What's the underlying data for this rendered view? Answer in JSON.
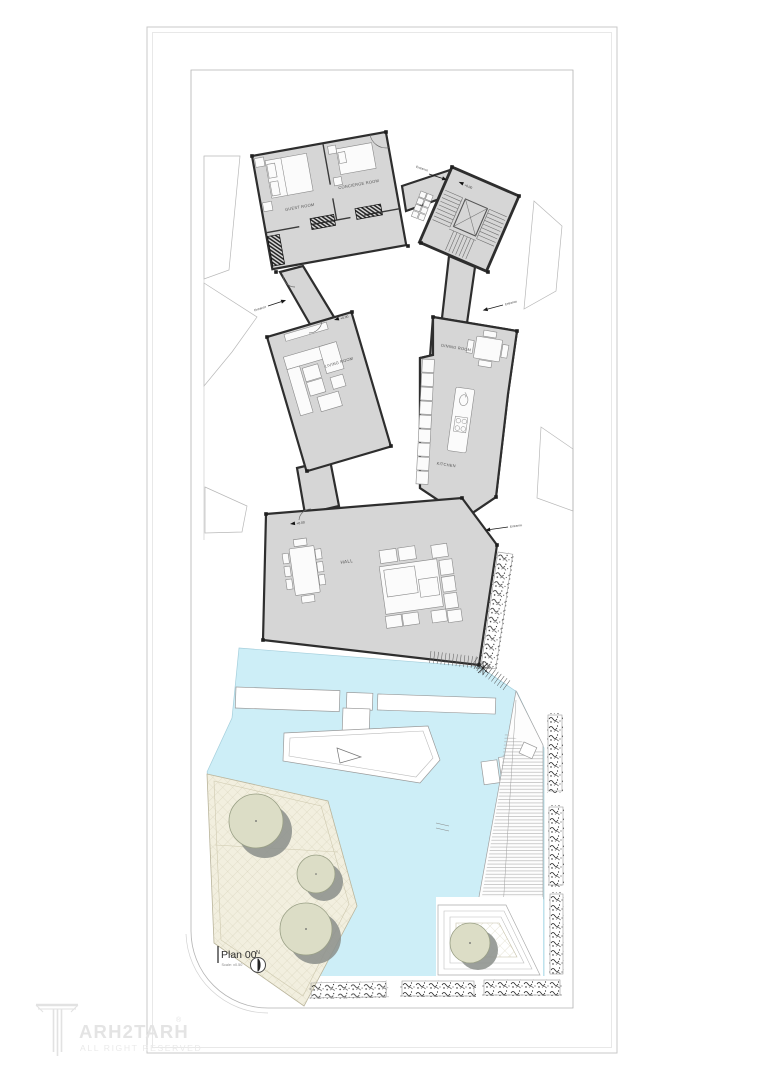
{
  "sheet": {
    "title_block": {
      "plan_name": "Plan 00",
      "scale_note": "Scale: x0.50",
      "north_label": "N"
    },
    "watermark": {
      "brand": "ARH2TARH",
      "registered_mark": "®",
      "tagline": "ALL RIGHT RESERVED"
    }
  },
  "rooms": [
    {
      "id": "guest-room",
      "label": "GUEST ROOM"
    },
    {
      "id": "concierge-room",
      "label": "CONCIERGE ROOM"
    },
    {
      "id": "living-room",
      "label": "LIVING ROOM"
    },
    {
      "id": "dining-room",
      "label": "DINING ROOM"
    },
    {
      "id": "kitchen",
      "label": "KITCHEN"
    },
    {
      "id": "hall",
      "label": "HALL"
    }
  ],
  "annotations": {
    "entrance_label": "Entrance",
    "level_marker_label": "+0.00"
  },
  "colors": {
    "building-fill": "#d6d6d6",
    "wall-stroke": "#2e2e2e",
    "pool-fill": "#cdeef7",
    "patio-fill": "#f2efdf",
    "patio-line": "#d6d1b8",
    "tree-fill": "#dcddc6",
    "tree-shadow": "#8d928d",
    "frame-line": "#c9c9c9",
    "site-line": "#b3b3b3",
    "furniture-fill": "#fbfbfb",
    "watermark-color": "#e4e4e4"
  }
}
